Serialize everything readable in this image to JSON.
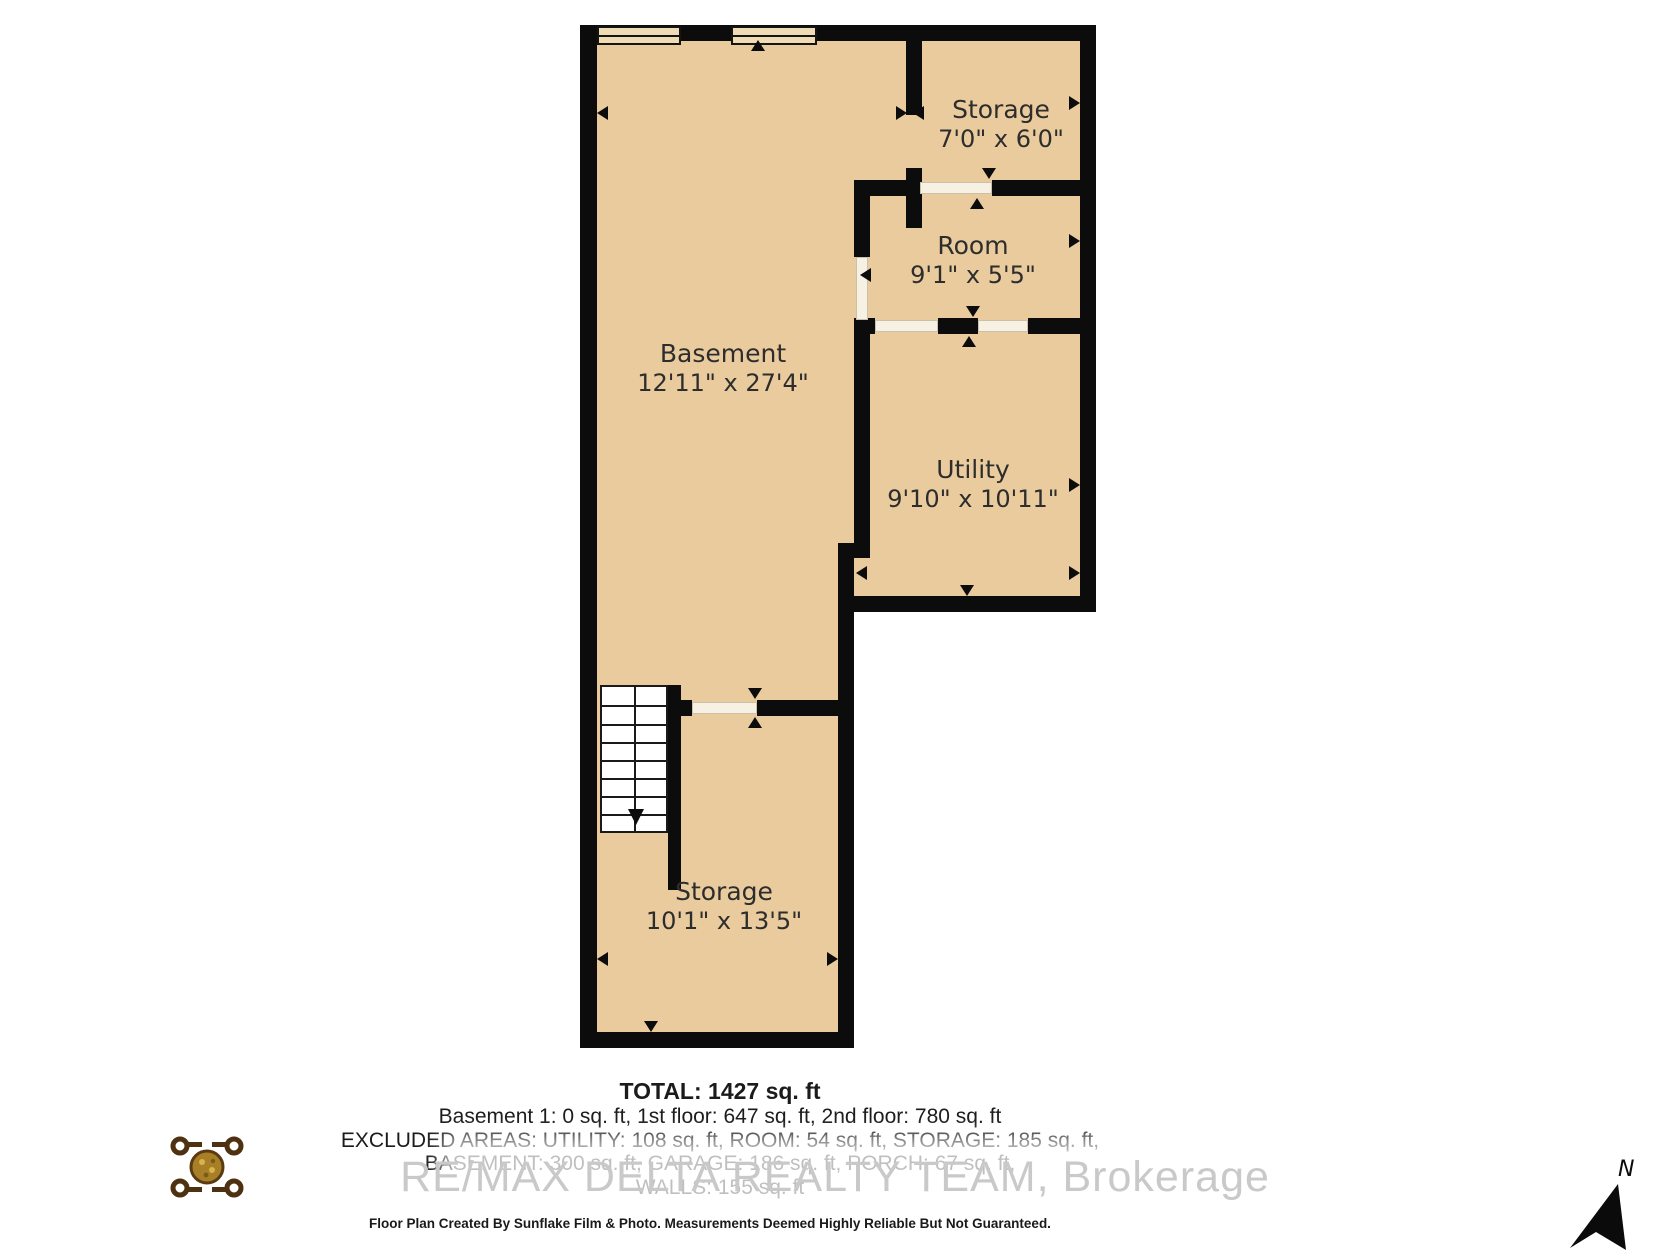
{
  "floor_plan": {
    "rooms": [
      {
        "id": "storage-top",
        "name": "Storage",
        "dims": "7'0\" x 6'0\""
      },
      {
        "id": "room",
        "name": "Room",
        "dims": "9'1\" x 5'5\""
      },
      {
        "id": "basement",
        "name": "Basement",
        "dims": "12'11\" x 27'4\""
      },
      {
        "id": "utility",
        "name": "Utility",
        "dims": "9'10\" x 10'11\""
      },
      {
        "id": "storage-bottom",
        "name": "Storage",
        "dims": "10'1\" x 13'5\""
      }
    ]
  },
  "summary": {
    "total": "TOTAL: 1427 sq. ft",
    "floors": "Basement 1: 0 sq. ft, 1st floor: 647 sq. ft, 2nd floor: 780 sq. ft",
    "excluded_1": "EXCLUDED AREAS: UTILITY: 108 sq. ft, ROOM: 54 sq. ft, STORAGE: 185 sq. ft,",
    "excluded_2": "BASEMENT: 300 sq. ft, GARAGE: 186 sq. ft, PORCH: 67 sq. ft,",
    "excluded_3": "WALLS: 155 sq. ft"
  },
  "watermark": "RE/MAX DELTA REALTY TEAM, Brokerage",
  "disclaimer": "Floor Plan Created By Sunflake Film & Photo. Measurements Deemed Highly Reliable But Not Guaranteed.",
  "compass": {
    "label": "N"
  },
  "colors": {
    "floor": "#e9cb9e",
    "wall": "#0c0c0c",
    "window_fill": "#f0dcb4",
    "door_fill": "#f7f1e4",
    "watermark": "#c9c9c9"
  }
}
